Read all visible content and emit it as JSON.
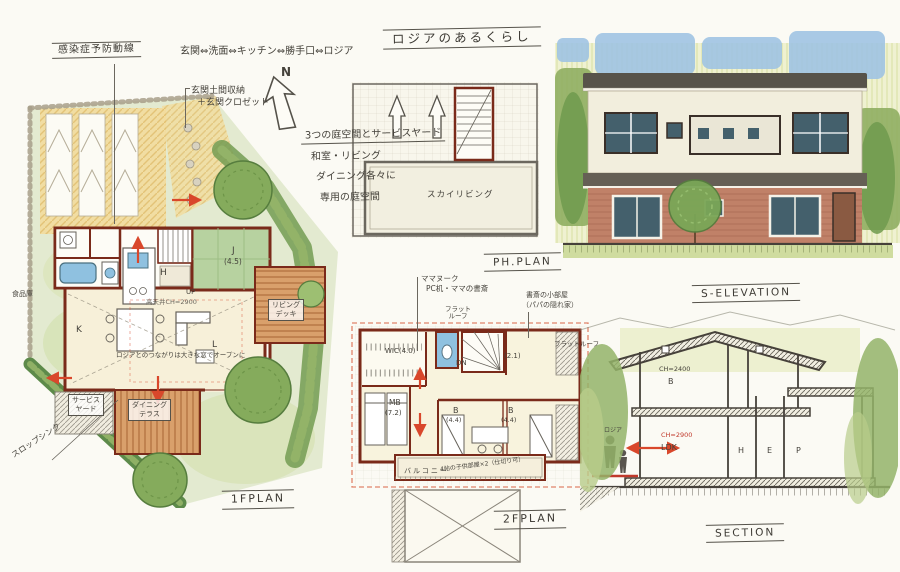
{
  "title": "ロジアのあるくらし",
  "annotations": {
    "flow_title": "感染症予防動線",
    "flow_route": "玄関⇔洗面⇔キッチン⇔勝手口⇔ロジア",
    "entry_note_1": "玄関土間収納",
    "entry_note_2": "＋玄関クロゼット",
    "north": "N",
    "garden_title": "3つの庭空間とサービスヤード",
    "garden_note_1": "和室・リビング",
    "garden_note_2": "ダイニング各々に",
    "garden_note_3": "専用の庭空間"
  },
  "plan_1f": {
    "label": "1FPLAN",
    "pantry": "食品庫",
    "tatami": "J",
    "tatami_size": "(4.5)",
    "hall": "H",
    "up": "UP",
    "kitchen": "K",
    "living": "L",
    "ceiling_note": "高天井CH=2900",
    "loggia_note": "ロジアとのつながりは大きな窓でオープンに",
    "living_deck_line1": "リビング",
    "living_deck_line2": "デッキ",
    "dining_terrace_line1": "ダイニング",
    "dining_terrace_line2": "テラス",
    "service_yard_line1": "サービス",
    "service_yard_line2": "ヤード",
    "slop_sink": "スロップシンク"
  },
  "plan_ph": {
    "label": "PH.PLAN",
    "sky_living": "スカイリビング"
  },
  "plan_2f": {
    "label": "2FPLAN",
    "mama_note_1": "ママヌーク",
    "mama_note_2": "PC机・ママの書斎",
    "flat_roof_line1": "フラット",
    "flat_roof_line2": "ルーフ",
    "flat_roof_right": "フラットルーフ",
    "papa_note_1": "書斎の小部屋",
    "papa_note_2": "（パパの隠れ家）",
    "wic": "WIC(4.0)",
    "dn": "DN",
    "small_room": "(2.1)",
    "master": "MB",
    "master_size": "(7.2)",
    "bed1": "B",
    "bed1_size": "(4.4)",
    "bed2": "B",
    "bed2_size": "(4.4)",
    "balcony": "バルコニー",
    "kids_note": "4帖の子供部屋×2（仕切り可）"
  },
  "elevation": {
    "label": "S-ELEVATION"
  },
  "section": {
    "label": "SECTION",
    "loggia": "ロジア",
    "ch_2f": "CH=2400",
    "room_2f": "B",
    "ch_1f": "CH=2900",
    "room_1f": "LDK",
    "hall": "H",
    "entrance": "E",
    "porch": "P"
  },
  "palette": {
    "wall": "#7a2a1a",
    "arrow": "#d9472b",
    "tatami": "#b7d2a0",
    "water": "#8fc1e0",
    "deck": "#c98a5a",
    "sky": "#9ec3e4",
    "garden": "#cfe0a8",
    "brick": "#bd7e64"
  }
}
